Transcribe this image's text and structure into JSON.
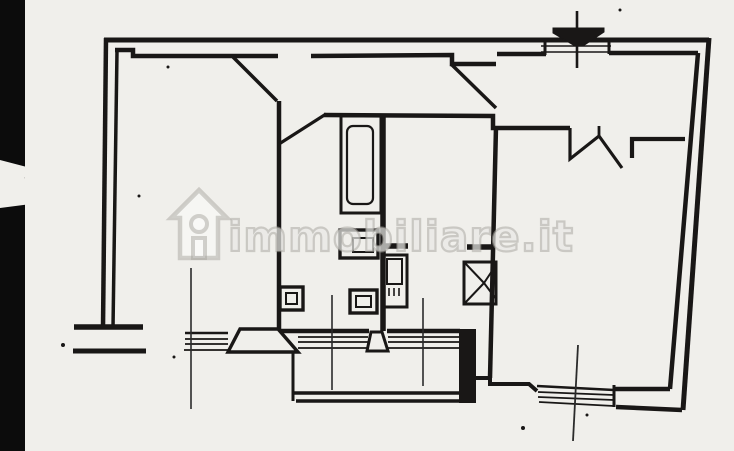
{
  "document": {
    "kind": "scanned-floor-plan"
  },
  "watermark": {
    "text": "immobiliare.it",
    "icon": "house-logo"
  },
  "colors": {
    "paper": "#f0efeb",
    "ink": "#191716",
    "dim": "#2b2b2b",
    "scan_edge": "#0c0c0c",
    "wm_stroke": "rgba(168,165,159,0.5)",
    "wm_fill": "rgba(252,251,249,0.55)"
  },
  "plan": {
    "width": 734,
    "height": 451,
    "shapes": [
      {
        "n": "outer-wall-top",
        "k": "line",
        "x1": 104,
        "y1": 40,
        "x2": 709,
        "y2": 40,
        "w": 5
      },
      {
        "n": "outer-wall-right",
        "k": "line",
        "x1": 709,
        "y1": 38,
        "x2": 683,
        "y2": 410,
        "w": 5
      },
      {
        "n": "outer-wall-left",
        "k": "line",
        "x1": 106,
        "y1": 38,
        "x2": 103,
        "y2": 328,
        "w": 4.5
      },
      {
        "n": "inner-wall-left",
        "k": "line",
        "x1": 117,
        "y1": 51,
        "x2": 113,
        "y2": 328,
        "w": 3.5
      },
      {
        "n": "inner-wall-top-a",
        "k": "polyline",
        "pts": [
          [
            115,
            50
          ],
          [
            133,
            50
          ],
          [
            133,
            56
          ],
          [
            278,
            56
          ]
        ],
        "w": 4.5
      },
      {
        "n": "inner-wall-top-b",
        "k": "polyline",
        "pts": [
          [
            311,
            56
          ],
          [
            452,
            55
          ],
          [
            452,
            64
          ],
          [
            496,
            64
          ]
        ],
        "w": 4.5
      },
      {
        "n": "inner-wall-top-c",
        "k": "line",
        "x1": 497,
        "y1": 54,
        "x2": 546,
        "y2": 54,
        "w": 4.5
      },
      {
        "n": "inner-wall-top-d",
        "k": "line",
        "x1": 609,
        "y1": 53,
        "x2": 698,
        "y2": 53,
        "w": 4.5
      },
      {
        "n": "flue-gap-line-a",
        "k": "line",
        "x1": 541,
        "y1": 46,
        "x2": 611,
        "y2": 46,
        "w": 1.4
      },
      {
        "n": "flue-gap-line-b",
        "k": "line",
        "x1": 541,
        "y1": 52,
        "x2": 611,
        "y2": 52,
        "w": 1.4
      },
      {
        "n": "flue-jamb-a",
        "k": "line",
        "x1": 545,
        "y1": 38,
        "x2": 545,
        "y2": 55,
        "w": 3
      },
      {
        "n": "flue-jamb-b",
        "k": "line",
        "x1": 609,
        "y1": 38,
        "x2": 609,
        "y2": 54,
        "w": 3
      },
      {
        "n": "flue-stack-line",
        "k": "line",
        "x1": 577,
        "y1": 11,
        "x2": 577,
        "y2": 68,
        "w": 2.6
      },
      {
        "n": "flue-symbol",
        "k": "polygon",
        "pts": [
          [
            553,
            28
          ],
          [
            604,
            28
          ],
          [
            604,
            32
          ],
          [
            583,
            46
          ],
          [
            575,
            46
          ],
          [
            553,
            33
          ]
        ],
        "f": "ink",
        "w": 1
      },
      {
        "n": "entry-door-leaf",
        "k": "line",
        "x1": 233,
        "y1": 57,
        "x2": 277,
        "y2": 101,
        "w": 3.5
      },
      {
        "n": "corridor-wall-left",
        "k": "line",
        "x1": 279,
        "y1": 101,
        "x2": 279,
        "y2": 331,
        "w": 4.5
      },
      {
        "n": "bath-door-leaf",
        "k": "line",
        "x1": 279,
        "y1": 144,
        "x2": 326,
        "y2": 114,
        "w": 3.2
      },
      {
        "n": "hall-bottom-wall",
        "k": "polyline",
        "pts": [
          [
            324,
            115
          ],
          [
            493,
            116
          ],
          [
            493,
            128
          ],
          [
            570,
            128
          ]
        ],
        "w": 4.5
      },
      {
        "n": "livingroom-door-zigzag",
        "k": "polyline",
        "pts": [
          [
            570,
            128
          ],
          [
            570,
            159
          ],
          [
            599,
            136
          ],
          [
            622,
            168
          ]
        ],
        "w": 3.2
      },
      {
        "n": "zigzag-tick",
        "k": "line",
        "x1": 599,
        "y1": 137,
        "x2": 599,
        "y2": 126,
        "w": 2.8
      },
      {
        "n": "kitchen-wall-stub",
        "k": "polyline",
        "pts": [
          [
            632,
            158
          ],
          [
            632,
            139
          ],
          [
            685,
            139
          ]
        ],
        "w": 4.2
      },
      {
        "n": "livingroom-wall-left",
        "k": "line",
        "x1": 496,
        "y1": 127,
        "x2": 490,
        "y2": 378,
        "w": 4.5
      },
      {
        "n": "livingroom-door-leaf",
        "k": "line",
        "x1": 451,
        "y1": 64,
        "x2": 496,
        "y2": 108,
        "w": 3.5
      },
      {
        "n": "bath-wall-right",
        "k": "line",
        "x1": 383,
        "y1": 114,
        "x2": 383,
        "y2": 331,
        "w": 5.5
      },
      {
        "n": "bottom-wall-a",
        "k": "line",
        "x1": 277,
        "y1": 331,
        "x2": 369,
        "y2": 331,
        "w": 4.5
      },
      {
        "n": "bottom-wall-b",
        "k": "line",
        "x1": 387,
        "y1": 331,
        "x2": 460,
        "y2": 331,
        "w": 4.5
      },
      {
        "n": "window-left-sill-1",
        "k": "line",
        "x1": 185,
        "y1": 333,
        "x2": 228,
        "y2": 333,
        "w": 2.4
      },
      {
        "n": "window-left-sill-2",
        "k": "line",
        "x1": 185,
        "y1": 339,
        "x2": 228,
        "y2": 339,
        "w": 1.7
      },
      {
        "n": "window-left-sill-3",
        "k": "line",
        "x1": 185,
        "y1": 344,
        "x2": 228,
        "y2": 344,
        "w": 1.7
      },
      {
        "n": "window-left-sill-4",
        "k": "line",
        "x1": 184,
        "y1": 350,
        "x2": 228,
        "y2": 350,
        "w": 1.7
      },
      {
        "n": "window-mid-sill-1",
        "k": "line",
        "x1": 298,
        "y1": 337,
        "x2": 368,
        "y2": 337,
        "w": 1.7
      },
      {
        "n": "window-mid-sill-2",
        "k": "line",
        "x1": 298,
        "y1": 342,
        "x2": 368,
        "y2": 342,
        "w": 1.7
      },
      {
        "n": "window-mid-sill-3",
        "k": "line",
        "x1": 298,
        "y1": 348,
        "x2": 368,
        "y2": 348,
        "w": 1.7
      },
      {
        "n": "window-mid2-sill-1",
        "k": "line",
        "x1": 388,
        "y1": 337,
        "x2": 459,
        "y2": 337,
        "w": 1.7
      },
      {
        "n": "window-mid2-sill-2",
        "k": "line",
        "x1": 388,
        "y1": 342,
        "x2": 459,
        "y2": 342,
        "w": 1.7
      },
      {
        "n": "window-mid2-sill-3",
        "k": "line",
        "x1": 388,
        "y1": 348,
        "x2": 459,
        "y2": 348,
        "w": 1.7
      },
      {
        "n": "balcony-threshold-left",
        "k": "polygon",
        "pts": [
          [
            240,
            329
          ],
          [
            278,
            329
          ],
          [
            298,
            352
          ],
          [
            228,
            352
          ]
        ],
        "f": "paper",
        "w": 3.4
      },
      {
        "n": "balcony-threshold-mid",
        "k": "polygon",
        "pts": [
          [
            371,
            332
          ],
          [
            382,
            332
          ],
          [
            388,
            351
          ],
          [
            367,
            351
          ]
        ],
        "f": "paper",
        "w": 3
      },
      {
        "n": "left-wall-end-cap",
        "k": "line",
        "x1": 74,
        "y1": 327,
        "x2": 143,
        "y2": 327,
        "w": 5.5
      },
      {
        "n": "balcony-left-stub",
        "k": "line",
        "x1": 73,
        "y1": 351,
        "x2": 146,
        "y2": 351,
        "w": 5
      },
      {
        "n": "balcony-left-edge",
        "k": "line",
        "x1": 293,
        "y1": 352,
        "x2": 293,
        "y2": 401,
        "w": 3
      },
      {
        "n": "balcony-front-outer",
        "k": "line",
        "x1": 293,
        "y1": 393,
        "x2": 476,
        "y2": 393,
        "w": 3.4
      },
      {
        "n": "balcony-front-inner",
        "k": "line",
        "x1": 296,
        "y1": 401,
        "x2": 476,
        "y2": 401,
        "w": 3.4
      },
      {
        "n": "balcony-right-pier",
        "k": "rect",
        "x": 459,
        "y": 329,
        "wd": 17,
        "h": 74,
        "f": "ink",
        "w": 0
      },
      {
        "n": "balcony-step-wall",
        "k": "polyline",
        "pts": [
          [
            476,
            378
          ],
          [
            490,
            378
          ],
          [
            490,
            384
          ],
          [
            529,
            384
          ],
          [
            537,
            391
          ]
        ],
        "w": 4
      },
      {
        "n": "br-window-sill-1",
        "k": "line",
        "x1": 537,
        "y1": 386,
        "x2": 614,
        "y2": 390,
        "w": 2.4
      },
      {
        "n": "br-window-sill-2",
        "k": "line",
        "x1": 538,
        "y1": 392,
        "x2": 614,
        "y2": 395,
        "w": 1.7
      },
      {
        "n": "br-window-sill-3",
        "k": "line",
        "x1": 538,
        "y1": 397,
        "x2": 614,
        "y2": 400,
        "w": 1.7
      },
      {
        "n": "br-window-sill-4",
        "k": "line",
        "x1": 539,
        "y1": 402,
        "x2": 614,
        "y2": 406,
        "w": 1.7
      },
      {
        "n": "br-window-jamb",
        "k": "line",
        "x1": 614,
        "y1": 385,
        "x2": 614,
        "y2": 407,
        "w": 3
      },
      {
        "n": "livingroom-wall-bottom-inner",
        "k": "line",
        "x1": 614,
        "y1": 389,
        "x2": 670,
        "y2": 389,
        "w": 4.5
      },
      {
        "n": "livingroom-wall-bottom-outer",
        "k": "line",
        "x1": 616,
        "y1": 407,
        "x2": 682,
        "y2": 410,
        "w": 4.5
      },
      {
        "n": "wall-right-inner",
        "k": "line",
        "x1": 698,
        "y1": 53,
        "x2": 670,
        "y2": 389,
        "w": 4.5
      },
      {
        "n": "bathtub-outer",
        "k": "rect",
        "x": 341,
        "y": 116,
        "wd": 40,
        "h": 97,
        "w": 3
      },
      {
        "n": "bathtub-inner",
        "k": "rect",
        "x": 347,
        "y": 126,
        "wd": 26,
        "h": 78,
        "rx": 6,
        "w": 2.2
      },
      {
        "n": "washbasin-outer",
        "k": "rect",
        "x": 340,
        "y": 230,
        "wd": 38,
        "h": 28,
        "w": 3.4
      },
      {
        "n": "washbasin-inner",
        "k": "rect",
        "x": 353,
        "y": 238,
        "wd": 20,
        "h": 14,
        "w": 2
      },
      {
        "n": "water-heater-outer",
        "k": "rect",
        "x": 383,
        "y": 255,
        "wd": 24,
        "h": 52,
        "w": 3
      },
      {
        "n": "water-heater-inner",
        "k": "rect",
        "x": 387,
        "y": 259,
        "wd": 15,
        "h": 25,
        "w": 2
      },
      {
        "n": "water-heater-tick-1",
        "k": "line",
        "x1": 389,
        "y1": 288,
        "x2": 389,
        "y2": 296,
        "w": 1.6
      },
      {
        "n": "water-heater-tick-2",
        "k": "line",
        "x1": 394,
        "y1": 288,
        "x2": 394,
        "y2": 296,
        "w": 1.6
      },
      {
        "n": "water-heater-tick-3",
        "k": "line",
        "x1": 399,
        "y1": 288,
        "x2": 399,
        "y2": 296,
        "w": 1.6
      },
      {
        "n": "wall-stub-bath",
        "k": "line",
        "x1": 382,
        "y1": 246,
        "x2": 408,
        "y2": 246,
        "w": 5.5
      },
      {
        "n": "wall-stub-corridor",
        "k": "line",
        "x1": 467,
        "y1": 247,
        "x2": 494,
        "y2": 247,
        "w": 5.5
      },
      {
        "n": "bidet-outer",
        "k": "rect",
        "x": 280,
        "y": 287,
        "wd": 23,
        "h": 23,
        "w": 3.4
      },
      {
        "n": "bidet-inner",
        "k": "rect",
        "x": 286,
        "y": 293,
        "wd": 11,
        "h": 11,
        "w": 2
      },
      {
        "n": "wc-outer",
        "k": "rect",
        "x": 350,
        "y": 290,
        "wd": 27,
        "h": 23,
        "w": 3.4
      },
      {
        "n": "wc-inner",
        "k": "rect",
        "x": 356,
        "y": 296,
        "wd": 15,
        "h": 11,
        "w": 2
      },
      {
        "n": "shower-box",
        "k": "rect",
        "x": 464,
        "y": 262,
        "wd": 32,
        "h": 42,
        "w": 3
      },
      {
        "n": "shower-line-1",
        "k": "line",
        "x1": 464,
        "y1": 262,
        "x2": 484,
        "y2": 283,
        "w": 2
      },
      {
        "n": "shower-line-2",
        "k": "line",
        "x1": 464,
        "y1": 304,
        "x2": 484,
        "y2": 283,
        "w": 2
      },
      {
        "n": "shower-line-3",
        "k": "line",
        "x1": 484,
        "y1": 283,
        "x2": 496,
        "y2": 265,
        "w": 2
      },
      {
        "n": "shower-line-4",
        "k": "line",
        "x1": 484,
        "y1": 283,
        "x2": 496,
        "y2": 299,
        "w": 2
      },
      {
        "n": "dim-line-left",
        "k": "line",
        "x1": 191,
        "y1": 268,
        "x2": 191,
        "y2": 409,
        "w": 1.6,
        "s": "dim"
      },
      {
        "n": "dim-line-mid-a",
        "k": "line",
        "x1": 332,
        "y1": 295,
        "x2": 332,
        "y2": 390,
        "w": 1.6,
        "s": "dim"
      },
      {
        "n": "dim-line-mid-b",
        "k": "line",
        "x1": 423,
        "y1": 298,
        "x2": 423,
        "y2": 386,
        "w": 1.6,
        "s": "dim"
      },
      {
        "n": "dim-line-right",
        "k": "line",
        "x1": 578,
        "y1": 345,
        "x2": 573,
        "y2": 441,
        "w": 1.8,
        "s": "dim"
      },
      {
        "n": "wm-house-outline",
        "k": "polygon",
        "pts": [
          [
            199,
            190
          ],
          [
            227,
            218
          ],
          [
            218,
            218
          ],
          [
            218,
            258
          ],
          [
            180,
            258
          ],
          [
            180,
            218
          ],
          [
            171,
            218
          ]
        ],
        "s": "wm_stroke",
        "f": "wm_fill",
        "w": 4.5
      },
      {
        "n": "wm-house-window",
        "k": "circle",
        "cx": 199,
        "cy": 224,
        "r": 8,
        "s": "wm_stroke",
        "f": "wm_fill",
        "w": 4
      },
      {
        "n": "wm-house-door",
        "k": "rect",
        "x": 193,
        "y": 238,
        "wd": 12,
        "h": 20,
        "s": "wm_stroke",
        "f": "wm_fill",
        "w": 4
      },
      {
        "n": "speck-1",
        "k": "dot",
        "cx": 168,
        "cy": 67,
        "r": 1.5
      },
      {
        "n": "speck-2",
        "k": "dot",
        "cx": 63,
        "cy": 345,
        "r": 2
      },
      {
        "n": "speck-3",
        "k": "dot",
        "cx": 174,
        "cy": 357,
        "r": 1.5
      },
      {
        "n": "speck-4",
        "k": "dot",
        "cx": 523,
        "cy": 428,
        "r": 2
      },
      {
        "n": "speck-5",
        "k": "dot",
        "cx": 587,
        "cy": 415,
        "r": 1.5
      },
      {
        "n": "speck-6",
        "k": "dot",
        "cx": 139,
        "cy": 196,
        "r": 1.5
      },
      {
        "n": "speck-7",
        "k": "dot",
        "cx": 620,
        "cy": 10,
        "r": 1.5
      },
      {
        "n": "scan-edge-bar",
        "k": "rect",
        "x": 0,
        "y": 0,
        "wd": 25,
        "h": 451,
        "f": "scan_edge",
        "w": 0
      },
      {
        "n": "scan-edge-notch",
        "k": "polygon",
        "pts": [
          [
            0,
            160
          ],
          [
            46,
            172
          ],
          [
            24,
            178
          ],
          [
            88,
            186
          ],
          [
            30,
            194
          ],
          [
            62,
            200
          ],
          [
            0,
            208
          ]
        ],
        "f": "paper",
        "w": 0
      }
    ]
  }
}
